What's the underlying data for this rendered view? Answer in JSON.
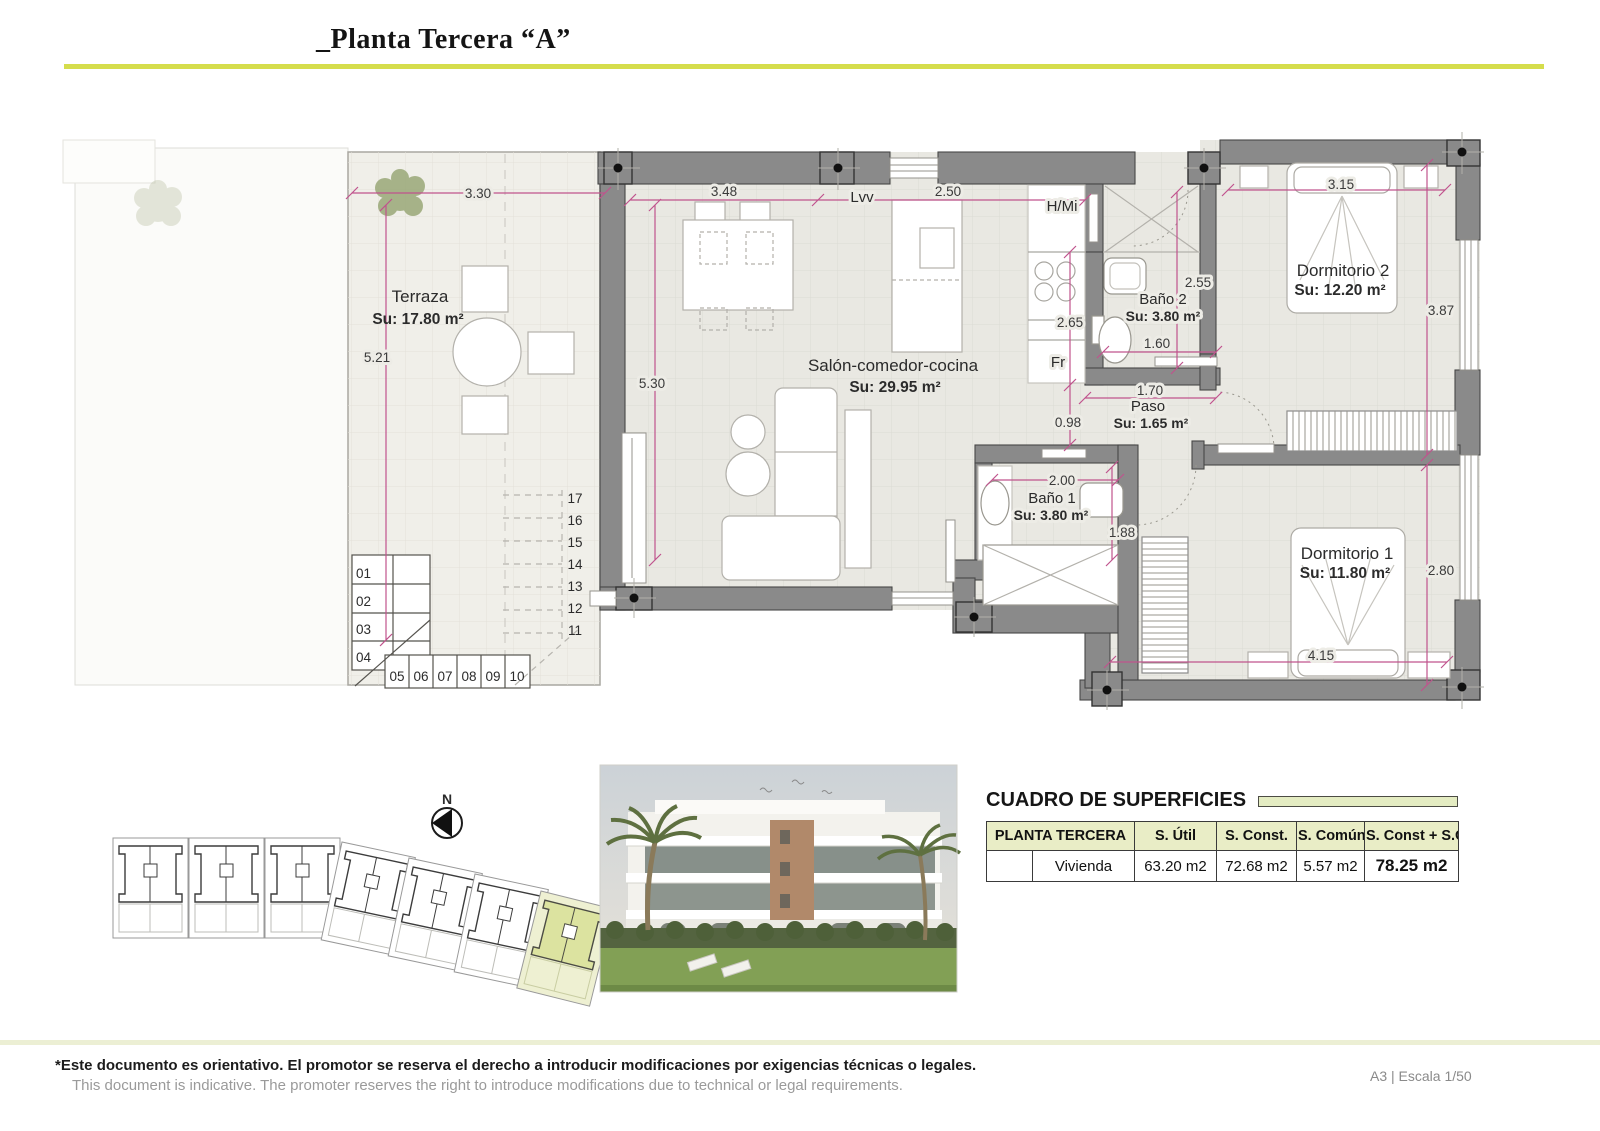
{
  "header": {
    "title": "_Planta Tercera “A”"
  },
  "plan": {
    "rooms": {
      "terraza": {
        "name": "Terraza",
        "area": "Su: 17.80 m²"
      },
      "salon": {
        "name": "Salón-comedor-cocina",
        "area": "Su: 29.95 m²"
      },
      "bano2": {
        "name": "Baño 2",
        "area": "Su: 3.80 m²"
      },
      "paso": {
        "name": "Paso",
        "area": "Su: 1.65 m²"
      },
      "bano1": {
        "name": "Baño 1",
        "area": "Su: 3.80 m²"
      },
      "dorm2": {
        "name": "Dormitorio 2",
        "area": "Su: 12.20 m²"
      },
      "dorm1": {
        "name": "Dormitorio 1",
        "area": "Su: 11.80 m²"
      }
    },
    "labels": {
      "lvv": "Lvv",
      "hmi": "H/Mi",
      "fr": "Fr"
    },
    "dims": {
      "terraza_w": "3.30",
      "terraza_h": "5.21",
      "salon_w": "3.48",
      "salon_h": "5.30",
      "kitchen_w": "2.50",
      "kitchen_h": "2.65",
      "bano2_h": "2.55",
      "bano2_door": "1.60",
      "paso_w": "1.70",
      "paso_h": "0.98",
      "dorm2_w": "3.15",
      "dorm2_h": "3.87",
      "bano1_w": "2.00",
      "bano1_h": "1.88",
      "dorm1_w": "4.15",
      "dorm1_h": "2.80"
    },
    "stairs": {
      "left": [
        "01",
        "02",
        "03",
        "04"
      ],
      "bottom": [
        "05",
        "06",
        "07",
        "08",
        "09",
        "10"
      ],
      "right": [
        "17",
        "16",
        "15",
        "14",
        "13",
        "12",
        "11"
      ]
    }
  },
  "siteplan": {
    "north_label": "N"
  },
  "table": {
    "title": "CUADRO DE SUPERFICIES",
    "headers": [
      "PLANTA TERCERA",
      "S. Útil",
      "S. Const.",
      "S. Común",
      "S. Const + S.C"
    ],
    "row": {
      "label": "Vivienda",
      "util": "63.20 m2",
      "const": "72.68 m2",
      "comun": "5.57 m2",
      "total": "78.25 m2"
    }
  },
  "footer": {
    "line1": "*Este documento es orientativo. El promotor se reserva el derecho a introducir modificaciones por exigencias técnicas o legales.",
    "line2": "This document is indicative. The promoter reserves the right to introduce modifications due to technical or legal requirements.",
    "scale": "A3 | Escala 1/50"
  },
  "colors": {
    "accent_line": "#d5dd4c",
    "table_header_bg": "#e9edc6",
    "dim_line": "#c0538d",
    "wall": "#8a8a8a",
    "highlight_unit": "#dce3a0"
  }
}
